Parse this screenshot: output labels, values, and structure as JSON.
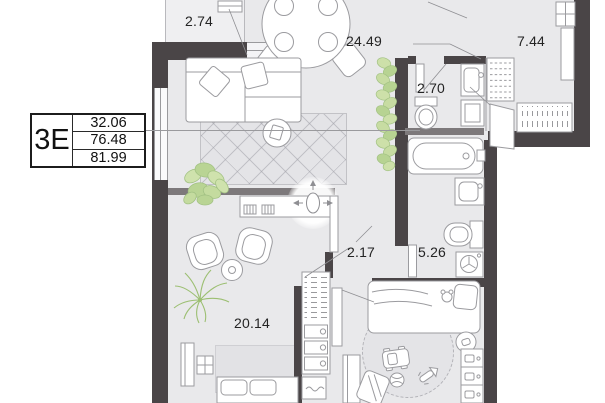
{
  "unit_card": {
    "type_label": "3Е",
    "area_values": [
      "32.06",
      "76.48",
      "81.99"
    ]
  },
  "rooms": [
    {
      "name": "balcony",
      "area": "2.74"
    },
    {
      "name": "living-kitchen",
      "area": "24.49"
    },
    {
      "name": "hallway",
      "area": "7.44"
    },
    {
      "name": "wc",
      "area": "2.70"
    },
    {
      "name": "corridor",
      "area": "2.17"
    },
    {
      "name": "bathroom",
      "area": "5.26"
    },
    {
      "name": "bedroom",
      "area": "20.14"
    }
  ],
  "colors": {
    "wall": "#4a4547",
    "floor": "#e9e9eb",
    "plant": "#c2da9c",
    "outline": "#9b9b9f"
  }
}
